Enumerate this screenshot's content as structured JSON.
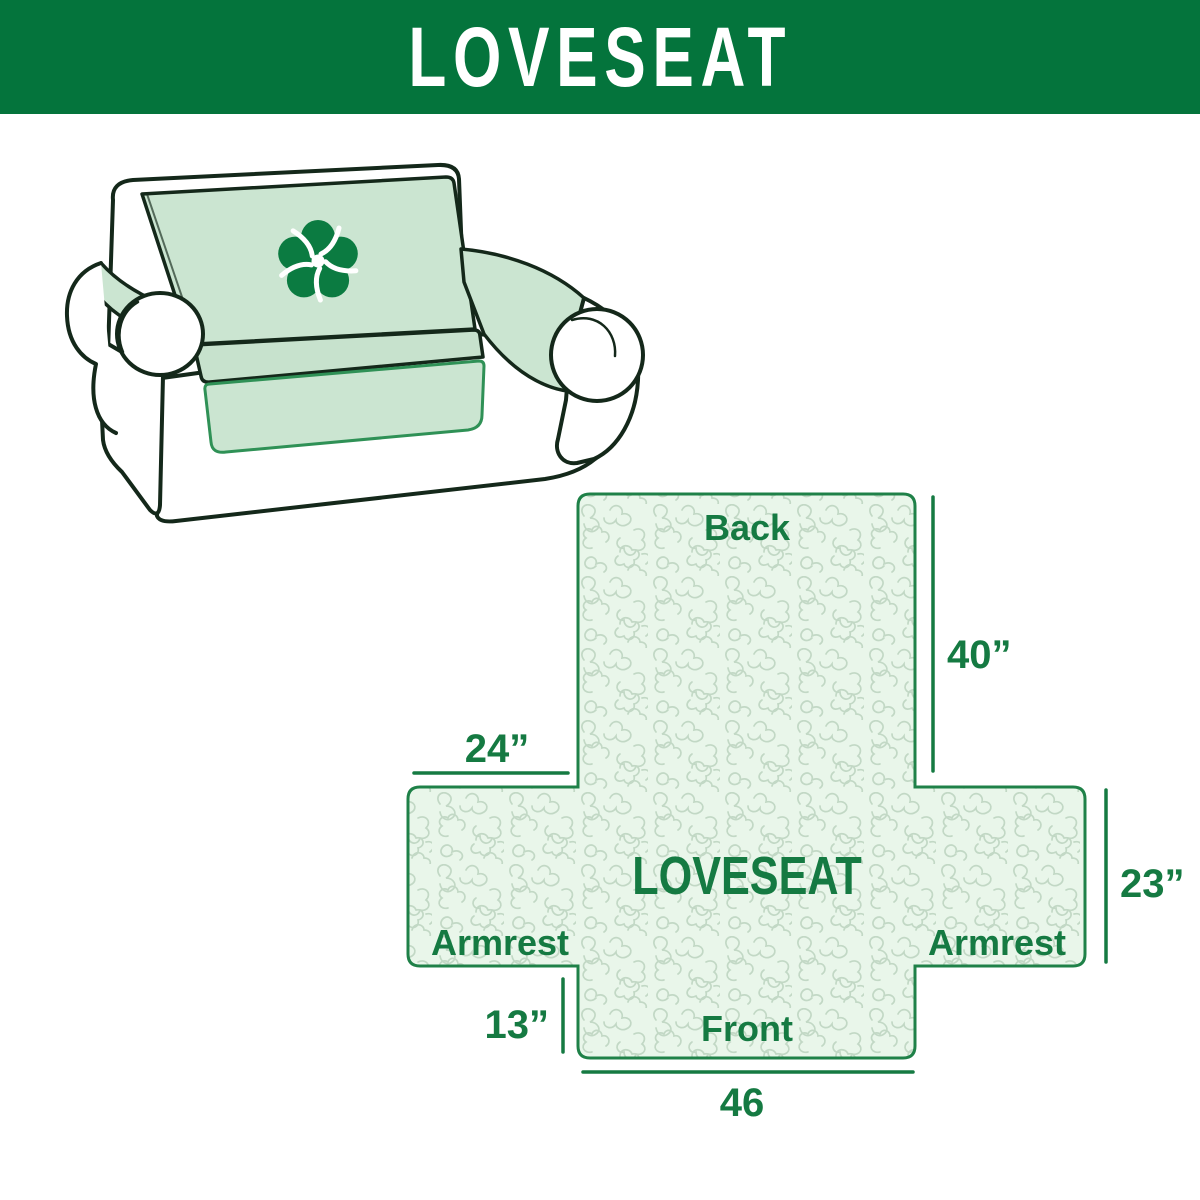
{
  "header": {
    "title": "LOVESEAT"
  },
  "sofa_illustration": {
    "logo_icon": "pinwheel-icon"
  },
  "diagram": {
    "center_label": "LOVESEAT",
    "back_label": "Back",
    "front_label": "Front",
    "armrest_left_label": "Armrest",
    "armrest_right_label": "Armrest",
    "dim_back_height": "40”",
    "dim_armrest_width": "24”",
    "dim_armrest_height": "23”",
    "dim_front_skirt_height": "13”",
    "dim_front_width": "46"
  },
  "colors": {
    "banner_green": "#04743c",
    "label_green": "#157a42",
    "diagram_border_green": "#1f8148",
    "diagram_fill": "#e9f6ea",
    "diagram_pattern": "#c2d8c5",
    "sofa_cover_mint": "#cbe5d1",
    "sofa_outline_dark": "#14281a",
    "sofa_accent_green": "#2f9156",
    "logo_green": "#0b7b41"
  }
}
